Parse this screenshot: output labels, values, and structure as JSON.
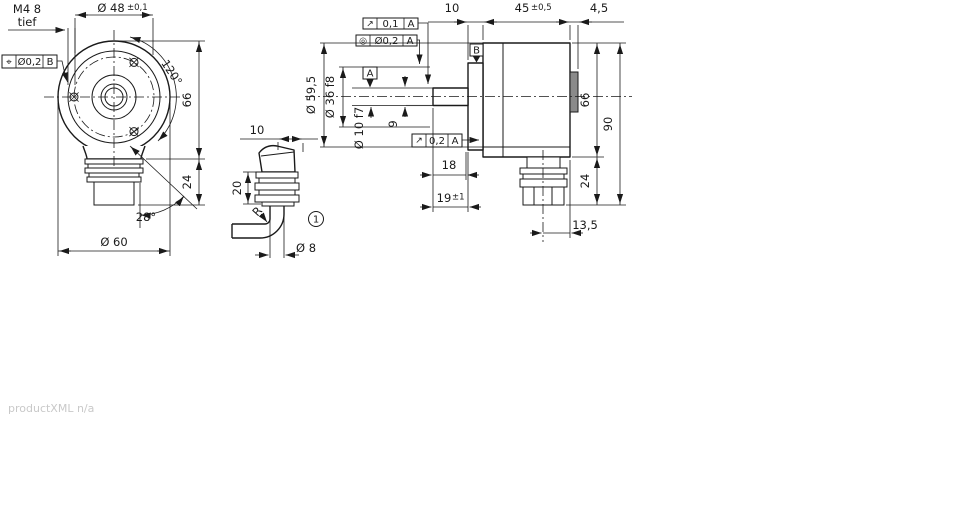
{
  "watermark": "productXML n/a",
  "front": {
    "m4_line1": "M4 8",
    "m4_line2": "tief",
    "dia48": "Ø 48",
    "dia48_tol": "±0,1",
    "pos_sym": "⌖",
    "pos_tol": "Ø0,2",
    "pos_datum": "B",
    "angle120": "120°",
    "dim66": "66",
    "dim24": "24",
    "angle28": "28°",
    "dia60": "Ø 60"
  },
  "cable": {
    "dim10": "10",
    "dim20": "20",
    "radius": "R",
    "callout": "1",
    "dia8": "Ø 8"
  },
  "side": {
    "runout_sym": "↗",
    "runout_tol": "0,1",
    "runout_datum": "A",
    "conc_sym": "◎",
    "conc_tol": "Ø0,2",
    "conc_datum": "A",
    "datumA": "A",
    "datumB": "B",
    "dim10": "10",
    "dim45": "45",
    "dim45_tol": "±0,5",
    "dim45x": "4,5",
    "dia595": "Ø 59,5",
    "dia36": "Ø 36 f8",
    "dia10": "Ø 10 f7",
    "dim9": "9",
    "runout2_sym": "↗",
    "runout2_tol": "0,2",
    "runout2_datum": "A",
    "dim18": "18",
    "dim19": "19",
    "dim19_tol": "±1",
    "dim66": "66",
    "dim90": "90",
    "dim24": "24",
    "dim135": "13,5"
  }
}
